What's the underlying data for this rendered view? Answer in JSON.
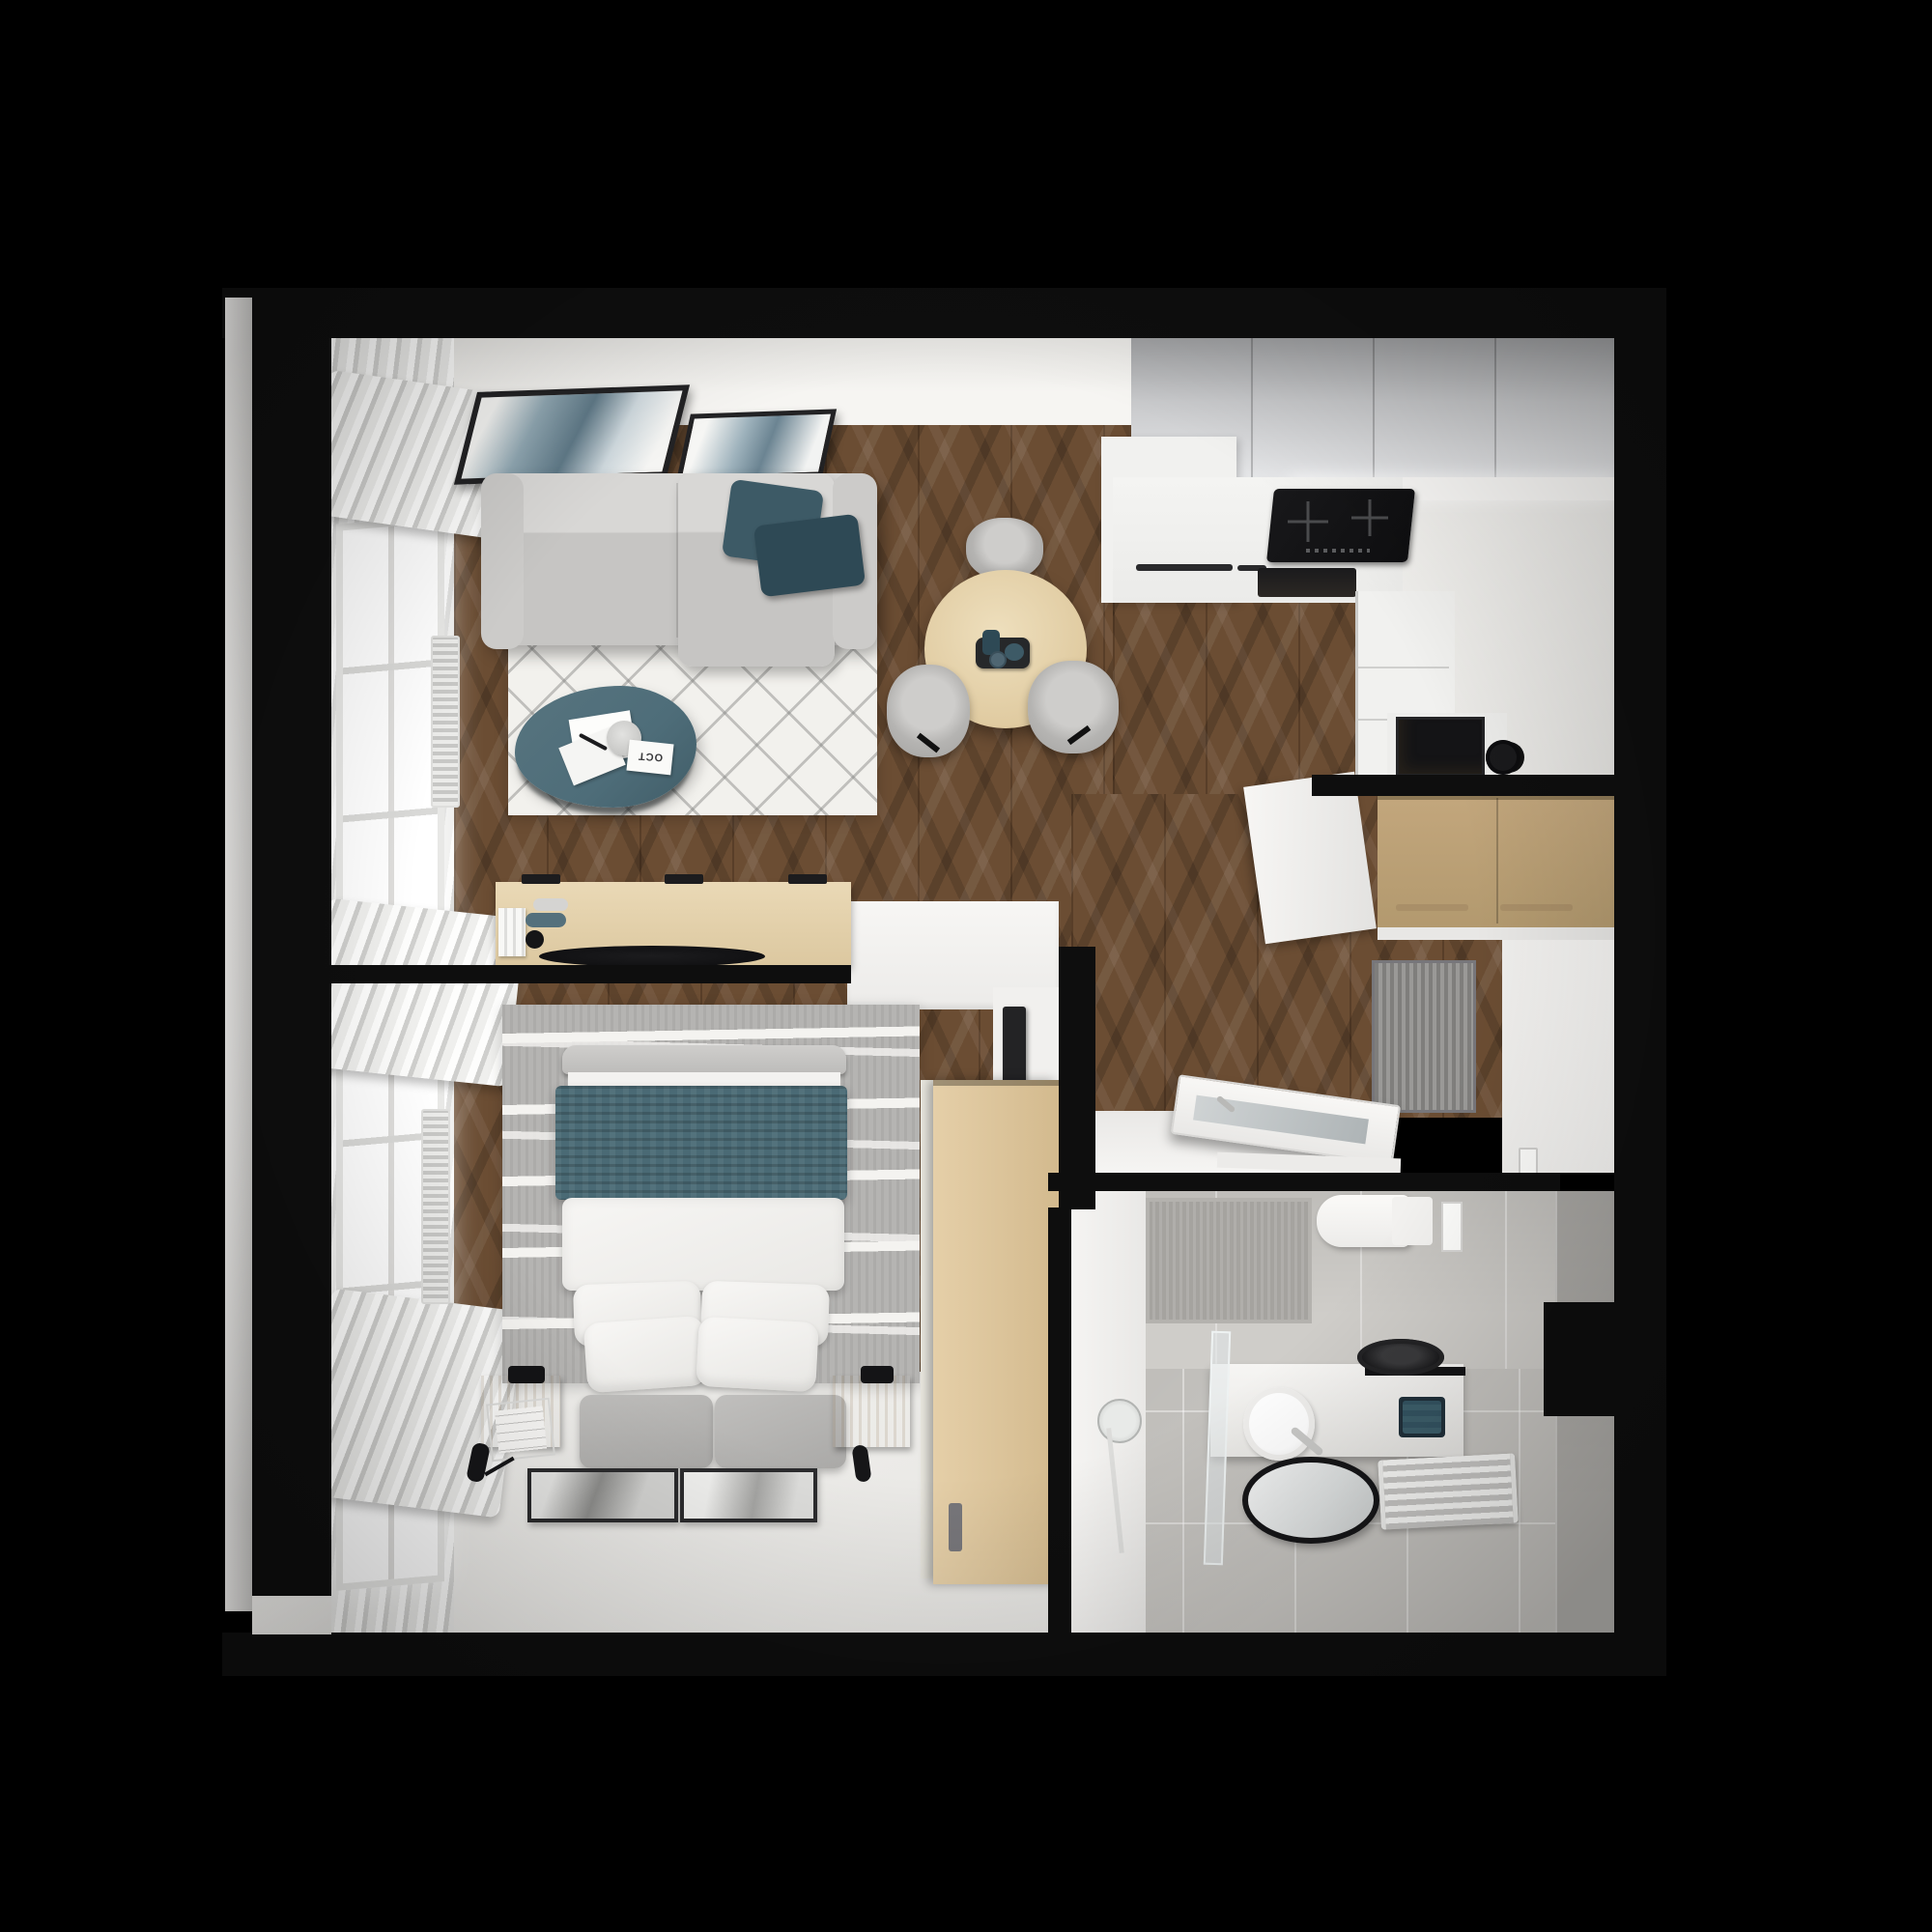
{
  "scene": {
    "type": "top-down-3d-floor-plan-render",
    "subject": "studio apartment with living room, kitchen, bedroom, hallway and bathroom",
    "background": "#000000",
    "magazine_label": "OCT"
  },
  "palette": {
    "bg": "#000000",
    "wall": "#0e0e0e",
    "wood_base": "#6b4d33",
    "wood_dark": "#4e3722",
    "wood_light": "#8a6a47",
    "oak": "#e6d3ac",
    "oak_dark": "#d2bc8f",
    "closet_tan": "#c2a67c",
    "white_floor": "#efeeeb",
    "wall_band": "#f6f5f2",
    "counter": "#f1f1ef",
    "cab_gray_1": "#9b9c9e",
    "cab_gray_2": "#e6e7e9",
    "appliance": "#141416",
    "sofa": "#c6c5c3",
    "sofa_light": "#d8d7d5",
    "sofa_dark": "#a9a8a6",
    "teal": "#3d5a66",
    "teal_dark": "#2e4955",
    "blanket_teal": "#4a6a75",
    "table_teal": "#4e6d79",
    "rug_white": "#f2f1ed",
    "rug_line": "#b9b8b5",
    "rug_gray": "#b5b4b2",
    "rug_wave": "#f4f3f0",
    "curtain": "#eeedec",
    "curtain_shadow": "#cfcfcd",
    "window_glow": "#ffffff",
    "tile_floor": "#c8c6c2",
    "tile_wall": "#cfcdc9",
    "shower_tile": "#a5a39f",
    "mat": "#8f8e8a",
    "doormat": "#8a8987",
    "mirror_glass": "#dfe2e2",
    "frame_dark": "#222224",
    "lamp_black": "#141416"
  },
  "rooms": [
    {
      "name": "living-room",
      "objects": [
        "sofa",
        "two-teal-cushions",
        "white-diamond-rug",
        "teal-coffee-table",
        "magazines",
        "two-wall-artworks",
        "window",
        "curtains",
        "radiator"
      ]
    },
    {
      "name": "dining-area",
      "objects": [
        "round-oak-table",
        "three-gray-chairs",
        "serving-tray",
        "teal-cups"
      ]
    },
    {
      "name": "kitchen",
      "objects": [
        "gray-upper-cabinets",
        "white-counter",
        "induction-cooktop",
        "built-in-oven",
        "appliance-column",
        "black-microwave-niche",
        "black-kettle"
      ]
    },
    {
      "name": "hallway",
      "objects": [
        "oak-entry-closet",
        "gray-doormat",
        "open-bathroom-door",
        "light-switch"
      ]
    },
    {
      "name": "bedroom",
      "objects": [
        "double-bed",
        "teal-knit-blanket",
        "white-duvet",
        "four-pillows",
        "gray-foot-bench",
        "two-oak-nightstands",
        "black-table-lamps",
        "gray-wave-rug",
        "oak-sideboard",
        "black-decor-bowl",
        "wardrobe",
        "tv-panel",
        "white-desk",
        "two-leaning-art-frames",
        "window",
        "curtains"
      ]
    },
    {
      "name": "bathroom",
      "objects": [
        "walk-in-shower",
        "glass-partition",
        "shower-head",
        "wall-hung-toilet",
        "flush-plate",
        "vanity-counter",
        "black-vessel-basin",
        "white-round-sink",
        "teal-towel",
        "oval-mirror",
        "towel-radiator",
        "gray-tiles"
      ]
    }
  ]
}
